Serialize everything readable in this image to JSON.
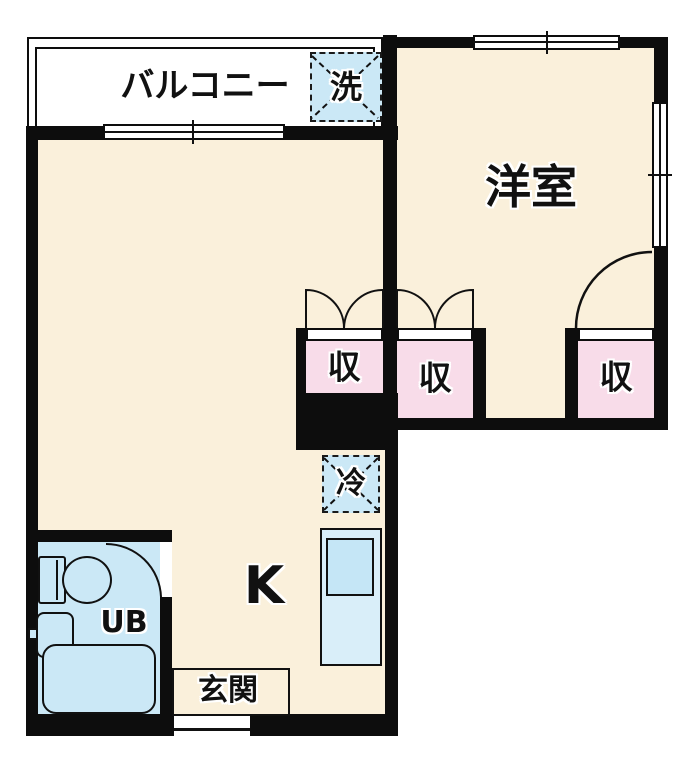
{
  "plan_type": "apartment-floor-plan",
  "colors": {
    "wall": "#0d0d0d",
    "room_floor": "#faf0db",
    "closet_fill": "#f8dce9",
    "water_fill": "#cbe8f6",
    "background": "#ffffff"
  },
  "labels": {
    "balcony": "バルコニー",
    "washer": "洗",
    "western_room": "洋室",
    "storage_left": "収",
    "storage_middle": "収",
    "storage_right": "収",
    "refrigerator": "冷",
    "kitchen": "K",
    "unit_bath": "UB",
    "entrance": "玄関"
  }
}
